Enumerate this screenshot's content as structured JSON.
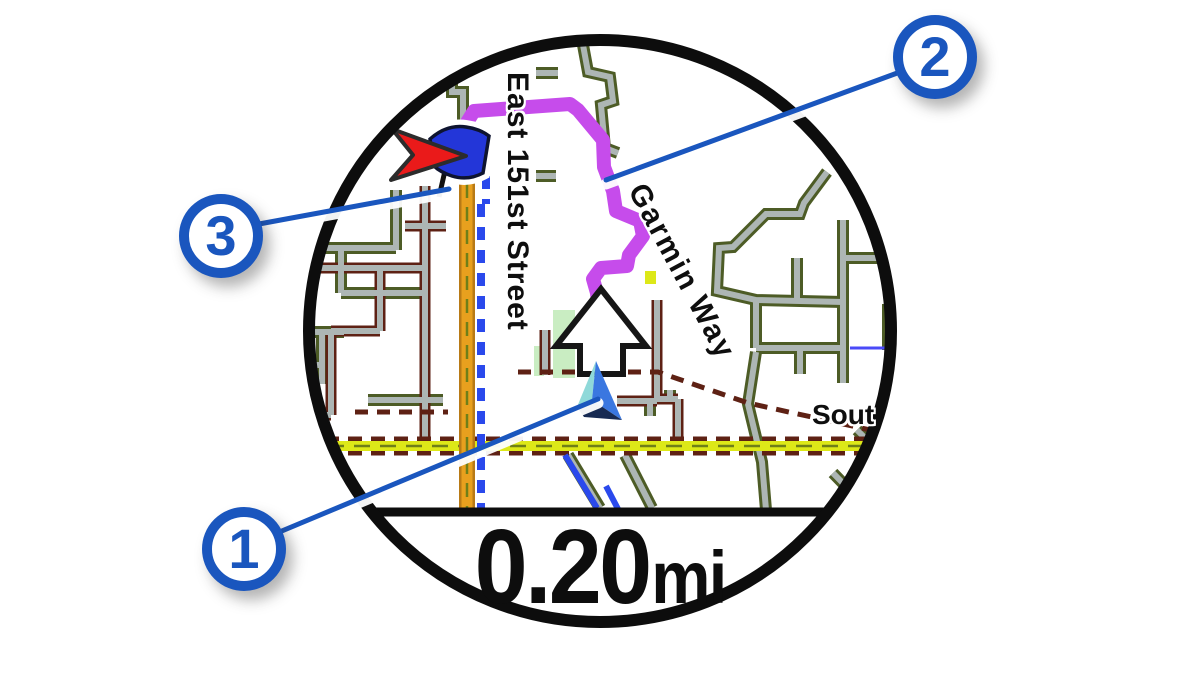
{
  "distance": {
    "value": "0.20",
    "unit": "mi"
  },
  "watch": {
    "cx": 600,
    "cy": 331,
    "r": 291,
    "bezel": 12,
    "divider_y": 512
  },
  "colors": {
    "ink": "#0d0d0d",
    "road_fill": "#adb6b4",
    "casing_olive": "#4d5c26",
    "casing_maroon": "#5e2114",
    "yellow": "#dde818",
    "yellow_center": "#6f7f18",
    "orange": "#e8a01e",
    "orange_casing": "#b87a16",
    "track_blue": "#2a49ec",
    "park": "#c9edc2",
    "stream": "#4a4af8",
    "route": "#c64ceb",
    "accent_blue": "#1a56be",
    "flag_blue": "#2336d8",
    "dest_red": "#ea1a1a",
    "pos_teal": "#8fd9d9",
    "pos_blue": "#3a77e0",
    "pos_navy": "#172a52"
  },
  "map": {
    "labels": [
      {
        "text": "East 151st Street",
        "x": 532,
        "y": 72,
        "rotate": 90,
        "size": 30,
        "spacing": 1
      },
      {
        "text": "Garmin Way",
        "x": 649,
        "y": 179,
        "rotate": 62,
        "size": 30,
        "spacing": 2
      },
      {
        "text": "Sout",
        "x": 812,
        "y": 401,
        "rotate": 0,
        "size": 28,
        "spacing": 0
      }
    ],
    "roads_olive": [
      "583,45 588,72 610,77 613,101 601,105 605,148 618,153",
      "536,73 558,73",
      "536,176 556,176",
      "827,172 804,203 800,214 766,214 733,247 719,248 717,291 756,300 843,302",
      "843,220 843,383",
      "843,258 889,258",
      "797,258 797,298",
      "756,300 756,348",
      "756,348 846,348",
      "800,348 800,374",
      "888,304 888,350",
      "303,248 396,248",
      "396,190 396,250",
      "341,248 341,293",
      "341,293 424,293",
      "303,332 344,332",
      "322,332 322,384",
      "303,365 322,365",
      "368,400 443,400",
      "568,455 600,508",
      "625,455 652,508",
      "756,352 748,404 762,462 766,510",
      "857,430 899,472",
      "833,473 871,512",
      "452,58 452,92 463,92 463,128",
      "650,399 650,416",
      "670,390 670,399"
    ],
    "roads_maroon": [
      "425,186 425,450",
      "303,268 424,268",
      "380,268 380,331",
      "331,331 380,331",
      "331,331 331,415",
      "303,415 331,415",
      "405,226 446,226",
      "657,300 657,399",
      "657,399 678,399",
      "678,399 678,443",
      "617,401 657,401",
      "545,330 545,375"
    ],
    "boundaries": [
      "518,372 658,372 748,403 884,433",
      "355,412 448,412"
    ],
    "yellow_road": {
      "y": 446,
      "x1": 302,
      "x2": 898
    },
    "orange_road": {
      "x": 467,
      "y1": 138,
      "y2": 511
    },
    "blue_track": [
      "486,130 486,204",
      "481,204 481,511"
    ],
    "blue_edges": [
      "565,455 597,508",
      "606,486 618,509"
    ],
    "stream": "850,348 897,348",
    "parks": [
      {
        "x": 553,
        "y": 310,
        "w": 22,
        "h": 68
      },
      {
        "x": 534,
        "y": 346,
        "w": 10,
        "h": 30
      }
    ],
    "speck": {
      "x": 645,
      "y": 271,
      "w": 11,
      "h": 13
    },
    "route": "466,124 474,111 570,104 578,110 603,140 604,167 613,191 616,211 640,221 643,236 629,255 627,266 601,268 593,279 597,293 598,303",
    "markers": {
      "turn_arrow": "601,289 646,346 623,346 623,374 580,374 580,346 556,346",
      "triangle_teal": "596,361 577,407 592,400",
      "triangle_blue": "596,361 622,420 592,400",
      "triangle_navy": "577,407 592,400 622,420 584,417",
      "dest_arrow": "392,129 466,156 391,180 413,155",
      "flag": "M430,139 Q447,124 466,127 Q480,129 489,136 L483,173 Q468,181 452,176 Q440,172 434,166 Z",
      "pole": {
        "x1": 447,
        "y1": 162,
        "x2": 439,
        "y2": 197
      }
    }
  },
  "callouts": [
    {
      "number": "1",
      "cx": 244,
      "cy": 549,
      "line": [
        277,
        533,
        598,
        399
      ]
    },
    {
      "number": "2",
      "cx": 935,
      "cy": 57,
      "line": [
        900,
        72,
        606,
        180
      ]
    },
    {
      "number": "3",
      "cx": 221,
      "cy": 236,
      "line": [
        259,
        224,
        449,
        189
      ]
    }
  ]
}
